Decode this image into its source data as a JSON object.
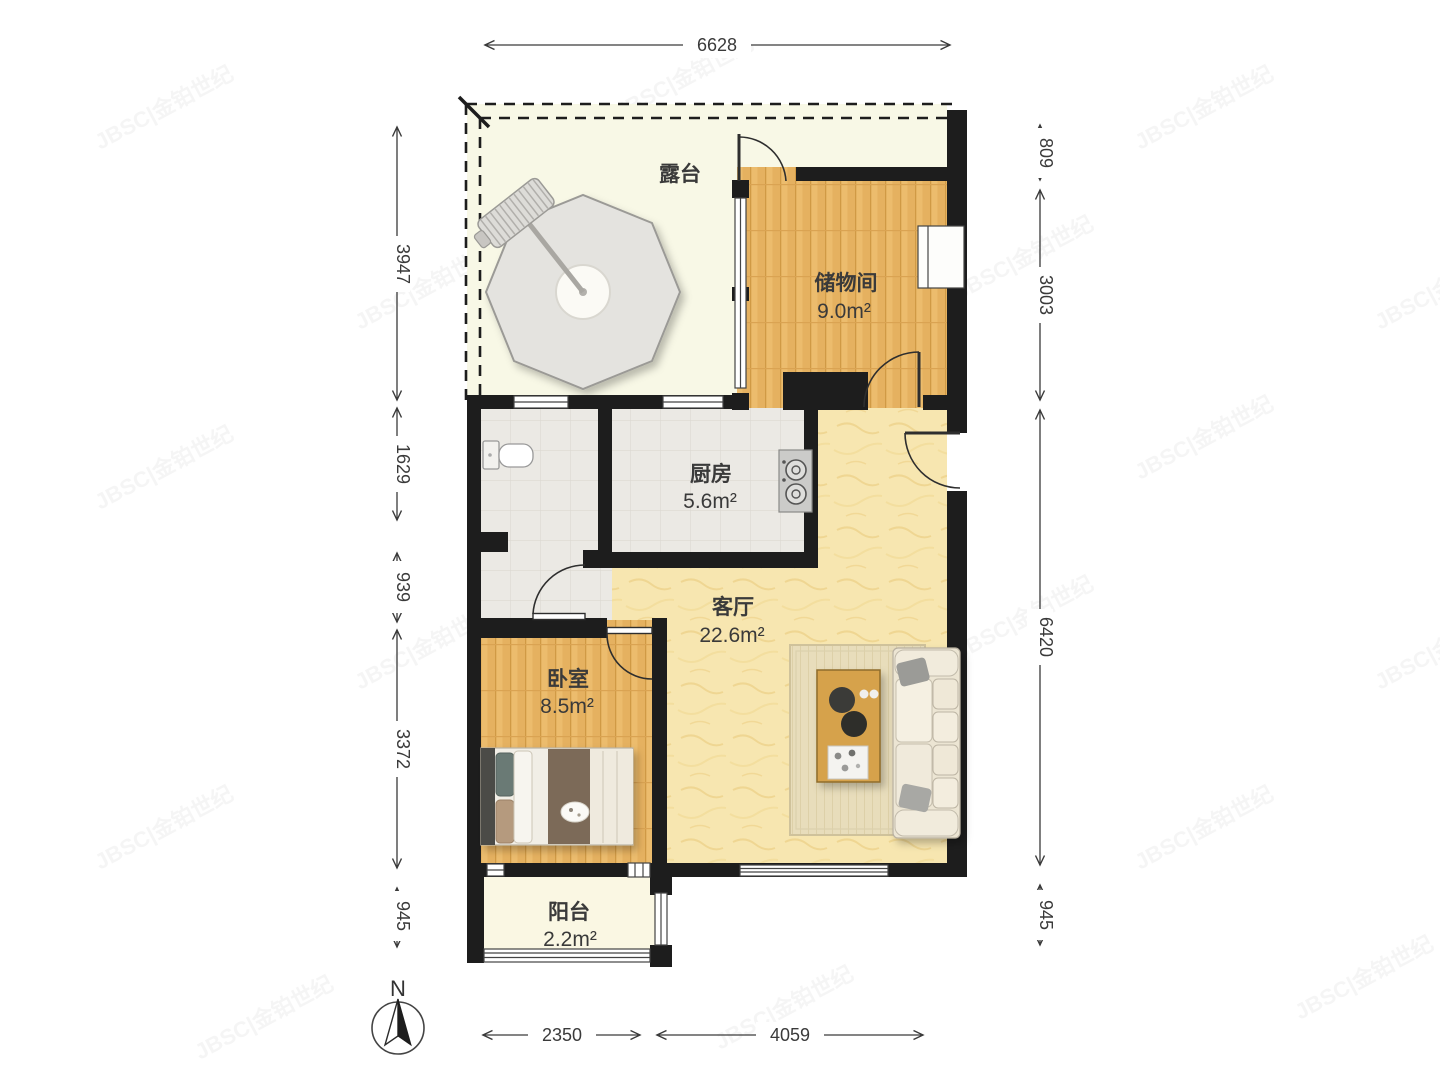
{
  "title": "户型图",
  "watermark": {
    "text": "JBSC|金铂世纪"
  },
  "compass": {
    "label": "N"
  },
  "rooms": {
    "terrace": {
      "name": "露台"
    },
    "storage": {
      "name": "储物间",
      "area": "9.0m²"
    },
    "kitchen": {
      "name": "厨房",
      "area": "5.6m²"
    },
    "living": {
      "name": "客厅",
      "area": "22.6m²"
    },
    "bedroom": {
      "name": "卧室",
      "area": "8.5m²"
    },
    "balcony": {
      "name": "阳台",
      "area": "2.2m²"
    }
  },
  "dimensions": {
    "top": [
      {
        "label": "6628"
      }
    ],
    "left": [
      {
        "label": "3947"
      },
      {
        "label": "1629"
      },
      {
        "label": "939"
      },
      {
        "label": "3372"
      },
      {
        "label": "945"
      }
    ],
    "right": [
      {
        "label": "809"
      },
      {
        "label": "3003"
      },
      {
        "label": "6420"
      },
      {
        "label": "945"
      }
    ],
    "bottom": [
      {
        "label": "2350"
      },
      {
        "label": "4059"
      }
    ]
  },
  "colors": {
    "wall": "#1d1d1d",
    "terrace_floor": "#f8f8e6",
    "balcony_floor": "#faf7e3",
    "wood_floor": "#ecbc6d",
    "tile_floor": "#ebe9e4",
    "marble_floor": "#f7e6b0",
    "dimension_line": "#3a3a3a"
  }
}
